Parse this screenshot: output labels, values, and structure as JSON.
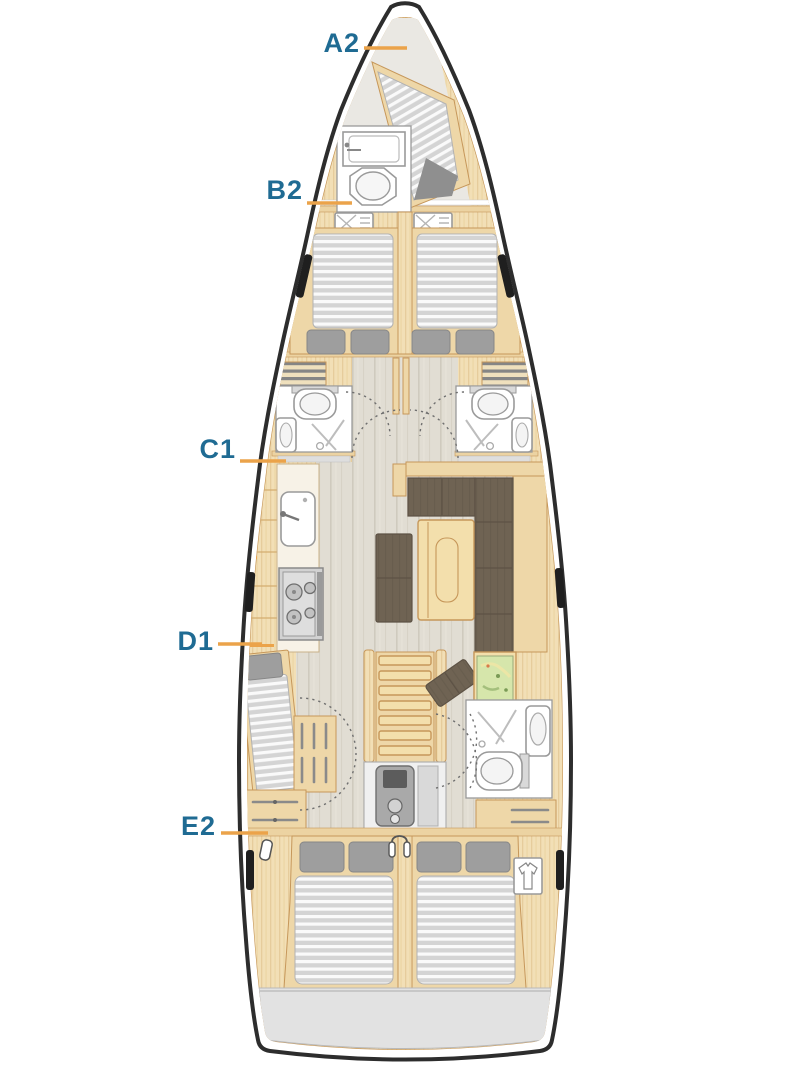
{
  "labels": {
    "a2": "A2",
    "b2": "B2",
    "c1": "C1",
    "d1": "D1",
    "e2": "E2"
  },
  "colors": {
    "label": "#1f6b93",
    "leader": "#eba34a",
    "hull": "#2d2d2d",
    "woodMid": "#eed7a8",
    "woodEdge": "#c6975a",
    "bulkhead": "#ecd3a2",
    "tableWood": "#f3dfac",
    "bowFloor": "#eae8e3",
    "mattress": "#d6d6d6",
    "pillow": "#9e9e9e",
    "berthFoot": "#8f8f8f",
    "sofa": "#6f6353",
    "sofaEdge": "#5d5245",
    "fixtureStroke": "#9a9a9a",
    "mapGreen": "#d6e6ab",
    "stern": "#e2e2e2",
    "portlight": "#1f1f1f"
  }
}
